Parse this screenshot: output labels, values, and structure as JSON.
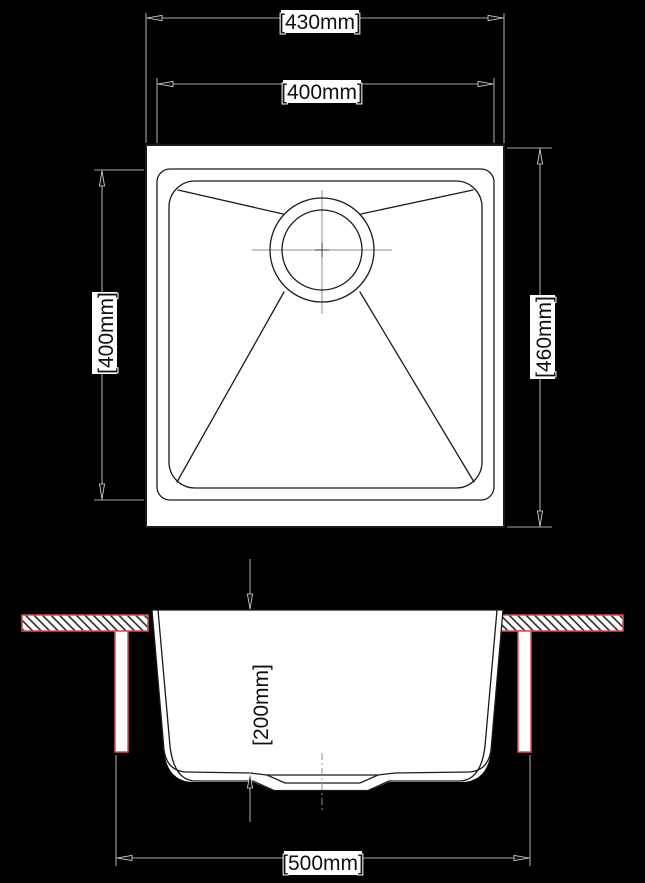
{
  "diagram": {
    "kind": "kitchen-sink technical drawing",
    "views": [
      "plan view (top)",
      "section view (front)"
    ]
  },
  "dimensions": {
    "plan_outer_width": "[430mm]",
    "plan_bowl_width": "[400mm]",
    "plan_bowl_height": "[400mm]",
    "plan_outer_height": "[460mm]",
    "section_depth": "[200mm]",
    "section_cutout_width": "[500mm]"
  },
  "colors": {
    "background": "#000000",
    "linework": "#1b1b1b",
    "fill": "#ffffff",
    "dimension_lines": "#a6a6a6",
    "countertop_accent": "#d94f4f"
  }
}
